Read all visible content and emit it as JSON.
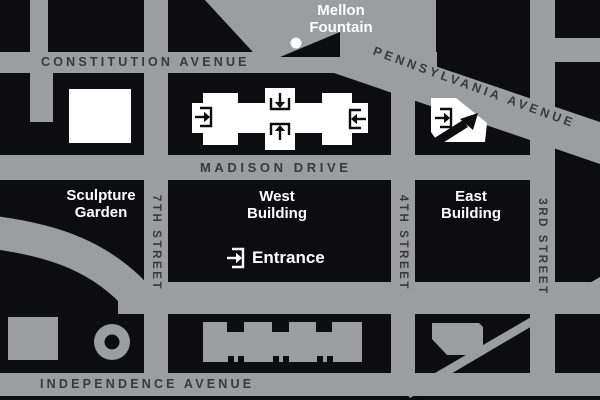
{
  "map_title": "National Gallery of Art area map",
  "colors": {
    "street_gray": "#9b9d9f",
    "block_black": "#0d0d0f",
    "building_white": "#ffffff",
    "street_label_dark": "#3a383b",
    "place_label_white": "#ffffff"
  },
  "streets": {
    "constitution": "CONSTITUTION AVENUE",
    "pennsylvania": "PENNSYLVANIA AVENUE",
    "madison": "MADISON DRIVE",
    "independence": "INDEPENDENCE AVENUE",
    "seventh": "7TH STREET",
    "fourth": "4TH STREET",
    "third": "3RD STREET"
  },
  "places": {
    "mellon_fountain": {
      "line1": "Mellon",
      "line2": "Fountain"
    },
    "sculpture_garden": {
      "line1": "Sculpture",
      "line2": "Garden"
    },
    "west_building": {
      "line1": "West",
      "line2": "Building"
    },
    "east_building": {
      "line1": "East",
      "line2": "Building"
    },
    "entrance": "Entrance"
  },
  "icons": {
    "entrance_arrow": "arrow-into-bracket",
    "mellon_fountain_dot": "white-dot"
  }
}
